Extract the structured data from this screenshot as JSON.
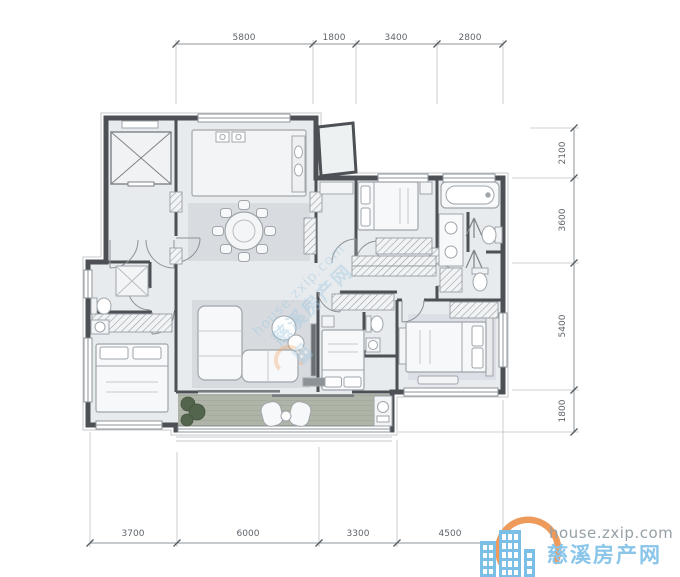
{
  "dimensions": {
    "top": [
      "5800",
      "1800",
      "3400",
      "2800"
    ],
    "right": [
      "2100",
      "3600",
      "5400",
      "1800"
    ],
    "bottom": [
      "3700",
      "6000",
      "3300",
      "4500"
    ]
  },
  "watermark": {
    "site": "house.zxip.com",
    "brand": "慈溪房产网"
  },
  "colors": {
    "wall": "#4d5156",
    "floor": "#e8ebed",
    "rug": "#d7dbdf",
    "balcony_deck": "#aeb5a8",
    "dimension_text": "#5f646a",
    "logo_orange": "#ee9a5a",
    "logo_building_blue": "#7cbfe6",
    "brand_text_blue": "#8ac5ea",
    "site_text_gray": "#95a0a7"
  }
}
